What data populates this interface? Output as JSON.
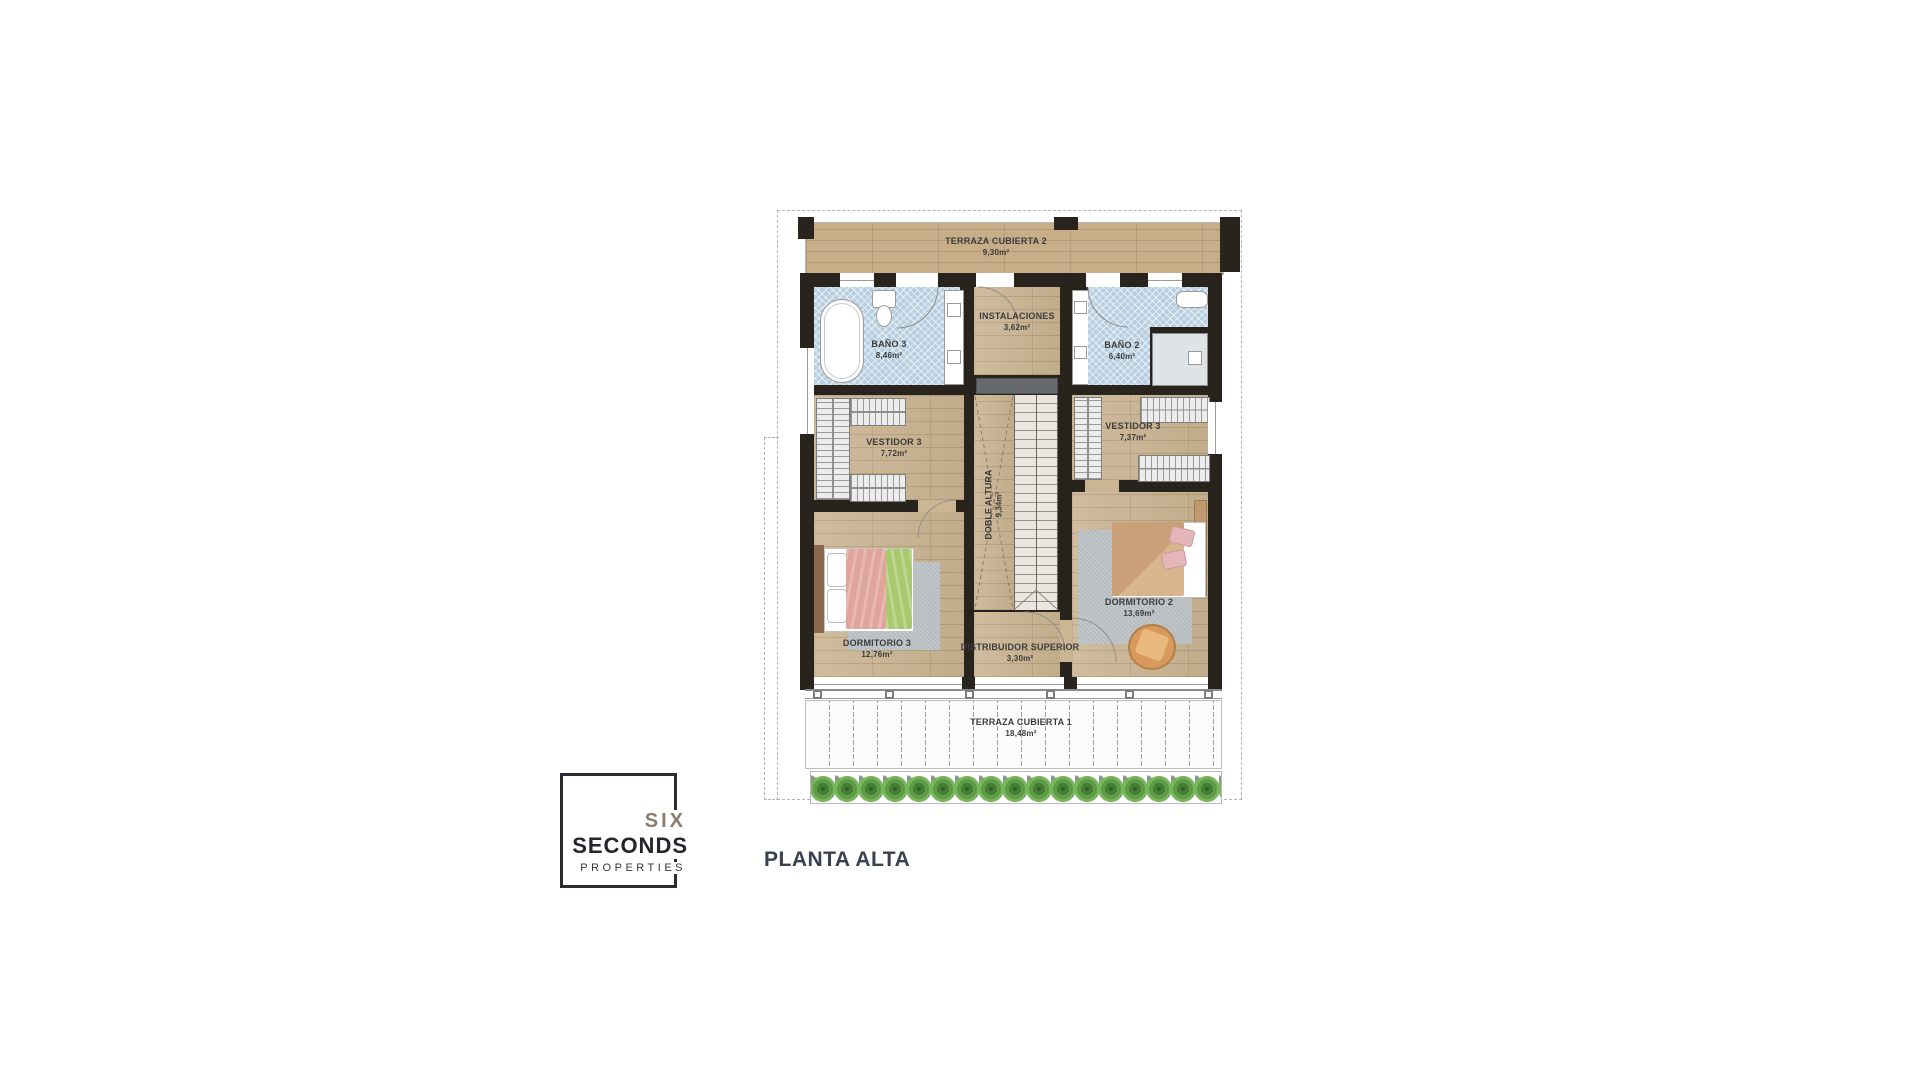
{
  "page": {
    "caption": "PLANTA ALTA"
  },
  "brand": {
    "line1": "SIX",
    "line2": "SECONDS",
    "line3": "PROPERTIES"
  },
  "rooms": {
    "terraza_cubierta_2": {
      "name": "TERRAZA CUBIERTA 2",
      "area": "9,30m²"
    },
    "bano_3": {
      "name": "BAÑO 3",
      "area": "8,46m²"
    },
    "instalaciones": {
      "name": "INSTALACIONES",
      "area": "3,62m²"
    },
    "bano_2": {
      "name": "BAÑO 2",
      "area": "6,40m²"
    },
    "vestidor_3_izq": {
      "name": "VESTIDOR 3",
      "area": "7,72m²"
    },
    "vestidor_3_der": {
      "name": "VESTIDOR 3",
      "area": "7,37m²"
    },
    "doble_altura": {
      "name": "DOBLE ALTURA",
      "area": "9,34m²"
    },
    "dormitorio_3": {
      "name": "DORMITORIO 3",
      "area": "12,76m²"
    },
    "distribuidor": {
      "name": "DISTRIBUIDOR SUPERIOR",
      "area": "3,30m²"
    },
    "dormitorio_2": {
      "name": "DORMITORIO 2",
      "area": "13,69m²"
    },
    "terraza_cubierta_1": {
      "name": "TERRAZA CUBIERTA 1",
      "area": "18,48m²"
    }
  },
  "fixtures": [
    "bathtub",
    "toilet",
    "double-sink-vanity",
    "shower",
    "wardrobe-closets",
    "staircase",
    "double-bed",
    "rug",
    "armchair",
    "planter-hedge",
    "railing",
    "door-swing-arcs"
  ],
  "colors": {
    "wall": "#29231e",
    "wood_floor": "#cbb592",
    "terrace_wood": "#c7ae89",
    "bath_tile": "#b7cfe0",
    "rug_gray": "#b6bdc5",
    "bed3_blanket_pink": "#dfa49a",
    "bed3_blanket_green": "#a9c96f",
    "bed2_blanket_tan": "#c9a077",
    "armchair_tan": "#d79a5c",
    "plants_green": "#4e8f3d",
    "brand_six": "#8b7c6e",
    "brand_dark": "#26242e",
    "caption_color": "#3a4150"
  }
}
